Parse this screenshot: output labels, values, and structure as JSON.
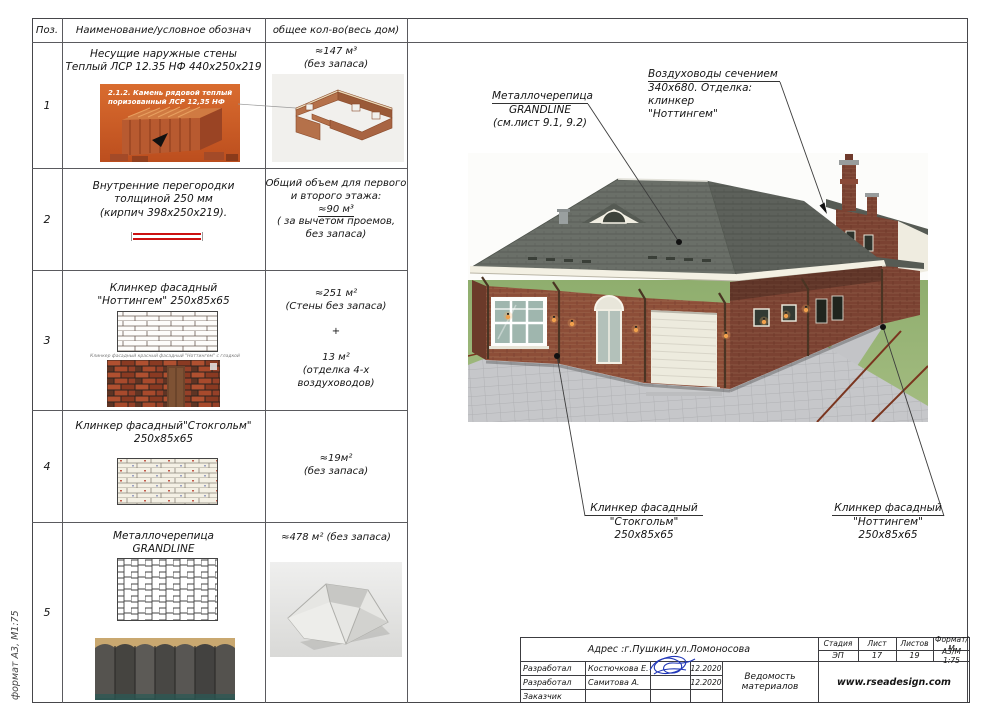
{
  "page": {
    "side_label": "формат А3, М1:75"
  },
  "colors": {
    "partition_symbol": "#cc1111",
    "signature_ink": "#2238b8",
    "brick": "#8a4a36",
    "roof": "#686d66"
  },
  "table": {
    "headers": {
      "pos": "Поз.",
      "name": "Наименование/условное обознач",
      "qty": "общее кол-во(весь дом)"
    },
    "rows": [
      {
        "pos": "1",
        "name_lines": [
          "Несущие наружные стены",
          "Теплый ЛСР 12.35 НФ 440х250х219"
        ],
        "photo_caption_lines": [
          "2.1.2. Камень рядовой теплый",
          "поризованный ЛСР 12,35 НФ"
        ],
        "qty_lines": [
          "≈147 м³",
          "(без запаса)"
        ]
      },
      {
        "pos": "2",
        "name_lines": [
          "Внутренние перегородки",
          "толщиной 250 мм",
          "(кирпич  398х250х219)."
        ],
        "qty_lines": [
          "Общий объем для первого",
          "и второго этажа:",
          "≈90 м³",
          "( за вычетом проемов,",
          "без запаса)"
        ]
      },
      {
        "pos": "3",
        "name_lines": [
          "Клинкер фасадный",
          "\"Ноттингем\" 250х85х65"
        ],
        "photo_caption": "Клинкер фасадный красный фасадный \"Ноттингем\" с гладкой",
        "qty_lines": [
          "≈251 м²",
          "(Стены без запаса)",
          "+",
          "13 м²",
          "(отделка 4-х",
          "воздуховодов)"
        ]
      },
      {
        "pos": "4",
        "name_lines": [
          "Клинкер фасадный\"Стокгольм\"",
          "250х85х65"
        ],
        "qty_lines": [
          "≈19м²",
          "(без запаса)"
        ]
      },
      {
        "pos": "5",
        "name_lines": [
          "Металлочерепица",
          "GRANDLINE"
        ],
        "qty_lines": [
          "≈478 м² (без запаса)"
        ]
      }
    ]
  },
  "annotations": {
    "grandline": {
      "lines": [
        "Металлочерепица",
        "GRANDLINE",
        "(см.лист 9.1, 9.2)"
      ]
    },
    "ducts": {
      "lines": [
        "Воздуховоды сечением",
        "340х680. Отделка: клинкер",
        "\"Ноттингем\""
      ]
    },
    "stockholm": {
      "lines": [
        "Клинкер фасадный",
        "\"Стокгольм\" 250х85х65"
      ]
    },
    "nottingham": {
      "lines": [
        "Клинкер фасадный",
        "\"Ноттингем\" 250х85х65"
      ]
    }
  },
  "title_block": {
    "address": "Адрес :г.Пушкин,ул.Ломоносова",
    "stage_label": "Стадия",
    "stage": "ЭП",
    "sheet_label": "Лист",
    "sheet": "17",
    "sheets_label": "Листов",
    "sheets": "19",
    "format_label": "Формат/М",
    "format": "А3/М 1:75",
    "rows": [
      {
        "role": "Разработал",
        "name": "Костючкова Е.",
        "date": "12.2020"
      },
      {
        "role": "Разработал",
        "name": "Самитова А.",
        "date": "12.2020"
      },
      {
        "role": "Заказчик",
        "name": "",
        "date": ""
      }
    ],
    "doc_title": "Ведомость материалов",
    "website": "www.rseadesign.com"
  }
}
